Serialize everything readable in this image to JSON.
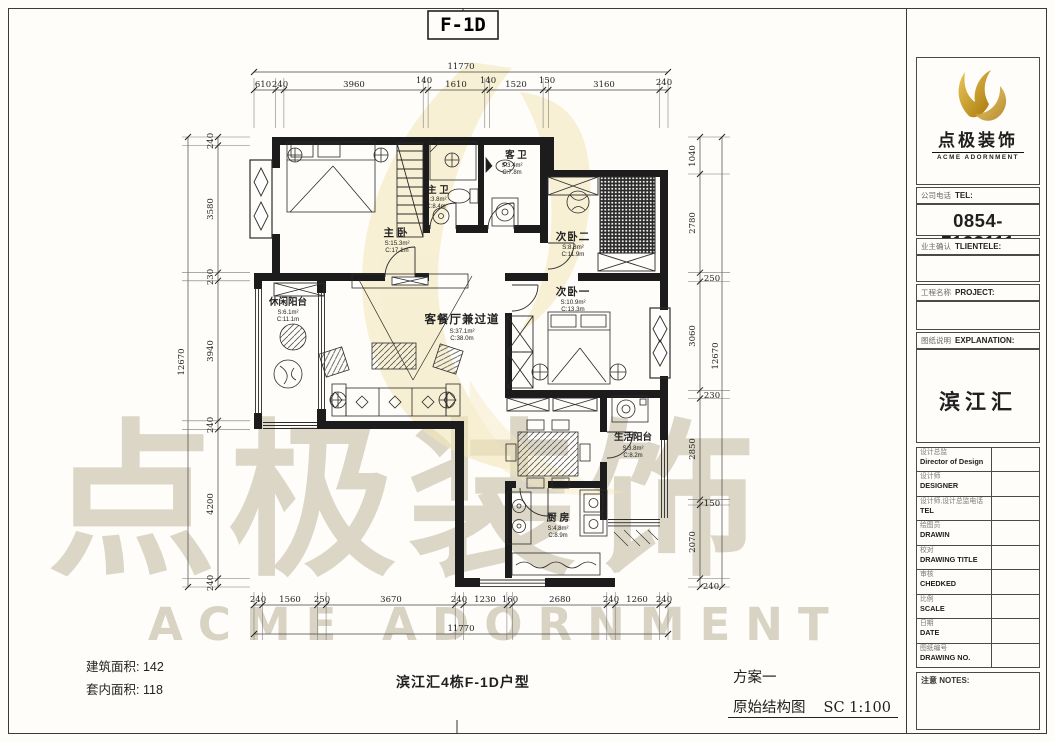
{
  "header": {
    "unit_label": "F-1D"
  },
  "rooms": {
    "master_bedroom": {
      "name": "主卧",
      "area": "S:15.3m²",
      "perimeter": "C:17.1m"
    },
    "master_bath": {
      "name": "主 卫",
      "area": "S:3.8m²",
      "perimeter": "C:8.4m"
    },
    "guest_bath": {
      "name": "客 卫",
      "area": "S:3.4m²",
      "perimeter": "C:7.8m"
    },
    "bedroom_two": {
      "name": "次卧二",
      "area": "S:8.8m²",
      "perimeter": "C:11.9m"
    },
    "bedroom_one": {
      "name": "次卧一",
      "area": "S:10.9m²",
      "perimeter": "C:13.3m"
    },
    "leisure_balcony": {
      "name": "休闲阳台",
      "area": "S:6.1m²",
      "perimeter": "C:11.1m"
    },
    "living_dining": {
      "name": "客餐厅兼过道",
      "area": "S:37.1m²",
      "perimeter": "C:38.0m"
    },
    "living_balcony": {
      "name": "生活阳台",
      "area": "S:3.8m²",
      "perimeter": "C:8.2m"
    },
    "kitchen": {
      "name": "厨 房",
      "area": "S:4.8m²",
      "perimeter": "C:8.9m"
    }
  },
  "dimensions": {
    "top": {
      "total": "11770",
      "segments": [
        "610",
        "240",
        "3960",
        "140",
        "1610",
        "140",
        "1520",
        "150",
        "3160",
        "240"
      ]
    },
    "bottom": {
      "total": "11770",
      "segments": [
        "240",
        "1560",
        "250",
        "3670",
        "240",
        "1230",
        "160",
        "2680",
        "240",
        "1260",
        "240"
      ]
    },
    "left": {
      "total": "12670",
      "segments": [
        "240",
        "3580",
        "230",
        "3940",
        "240",
        "4200",
        "240"
      ]
    },
    "right": {
      "total": "12670",
      "segments": [
        "1040",
        "2780",
        "250",
        "3060",
        "230",
        "2850",
        "150",
        "2070",
        "240"
      ]
    }
  },
  "footer": {
    "building_area_label": "建筑面积:",
    "building_area_value": "142",
    "inner_area_label": "套内面积:",
    "inner_area_value": "118",
    "plan_title": "滨江汇4栋F-1D户型",
    "scheme_label": "方案一",
    "drawing_name": "原始结构图",
    "scale_text": "SC 1:100"
  },
  "title_block": {
    "brand_cn": "点极装饰",
    "brand_en": "ACME ADORNMENT",
    "company_tel_cn": "公司电话",
    "company_tel_en": "TEL:",
    "phone": "0854-7133111",
    "client_cn": "业主确认",
    "client_en": "TLIENTELE:",
    "project_cn": "工程名称",
    "project_en": "PROJECT:",
    "explanation_cn": "图纸说明",
    "explanation_en": "EXPLANATION:",
    "project_name": "滨江汇",
    "rows": [
      {
        "cn": "设计总监",
        "en": "Director of Design"
      },
      {
        "cn": "设计师",
        "en": "DESIGNER"
      },
      {
        "cn": "设计师,设计总监电话",
        "en": "TEL"
      },
      {
        "cn": "绘图员",
        "en": "DRAWIN"
      },
      {
        "cn": "校对",
        "en": "DRAWING TITLE"
      },
      {
        "cn": "审核",
        "en": "CHEDKED"
      },
      {
        "cn": "比例",
        "en": "SCALE"
      },
      {
        "cn": "日期",
        "en": "DATE"
      },
      {
        "cn": "图纸编号",
        "en": "DRAWING NO."
      }
    ],
    "notes_label": "注意 NOTES:"
  },
  "watermark": {
    "brand_cn": "点极装饰",
    "brand_en": "ACME ADORNMENT"
  },
  "colors": {
    "gold": "#c9972b",
    "gold_light": "#e9c75a",
    "leaf": "#f3e7ba",
    "watermark_text": "#dcd6c7",
    "line": "#1f1f1f"
  }
}
